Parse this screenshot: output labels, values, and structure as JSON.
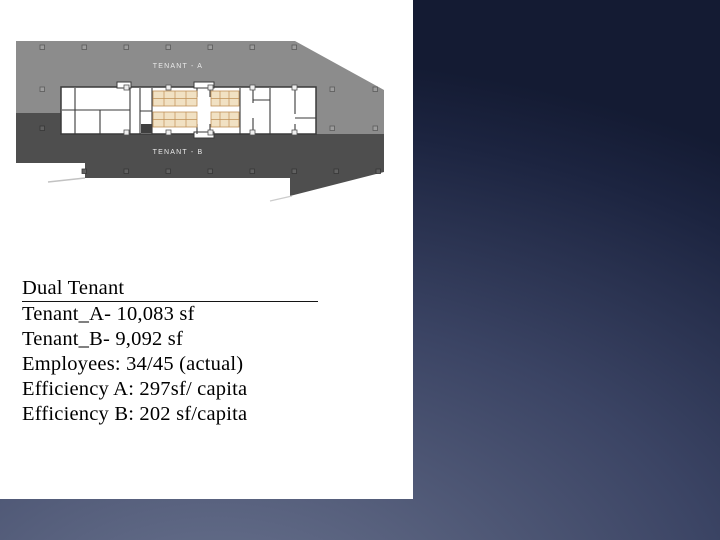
{
  "floor_plan": {
    "tenant_a_label": "TENANT - A",
    "tenant_b_label": "TENANT - B",
    "colors": {
      "tenant_a_zone": "#8c8c8c",
      "tenant_b_zone": "#4e4e4e",
      "rooms": "#ffffff",
      "walls": "#3a3a3a",
      "furniture": "#f1e1c3",
      "furniture_outline": "#c09158"
    }
  },
  "stats": {
    "heading": "Dual Tenant",
    "lines": [
      "Tenant_A- 10,083 sf",
      "Tenant_B- 9,092 sf",
      "Employees: 34/45 (actual)",
      "Efficiency A: 297sf/ capita",
      "Efficiency B: 202 sf/capita"
    ]
  },
  "theme": {
    "background_dark": "#141b33",
    "background_light": "#6a7490",
    "panel_background": "#ffffff",
    "text_color": "#000000"
  }
}
